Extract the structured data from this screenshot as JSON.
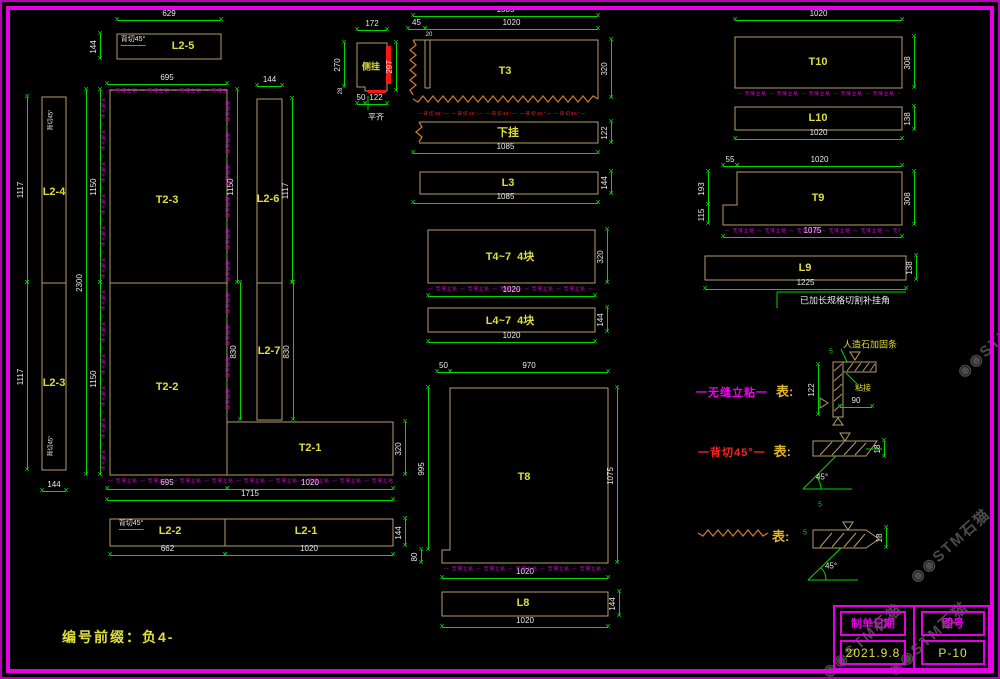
{
  "sheet": {
    "width": 1000,
    "height": 679,
    "watermark": "◉◉STM石猫"
  },
  "colors": {
    "magenta": "#e400e4",
    "green": "#00d800",
    "tan": "#b49b6e",
    "yellow": "#dede3c",
    "red": "#ff1414",
    "orange": "#c87830",
    "white": "#e8e8e8",
    "watermark": "#545454"
  },
  "prefix_note": "编号前缀：负4-",
  "title_block": {
    "col1_header": "制单日期",
    "col2_header": "图号",
    "date": "2021.9.8",
    "sheet_no": "P-10"
  },
  "legend": {
    "row1": {
      "style_label": "一无缝立粘一",
      "means_label": "表:"
    },
    "row2": {
      "style_label": "一背切45°一",
      "means_label": "表:"
    },
    "row3": {
      "means_label": "表:"
    }
  },
  "micro_m": "— 无缝立粘 — 无缝立粘 — 无缝立粘 — 无缝立粘 — 无缝立粘 — 无缝立粘 — 无缝立粘 — 无缝立粘 — 无缝立粘 — 无缝立粘 — 无缝立粘 — 无缝立粘 —",
  "micro_r": "—背切45°— —背切45°— —背切45°— —背切45°— —背切45°—",
  "labels": [
    [
      "T2-3",
      167,
      200
    ],
    [
      "T2-2",
      167,
      387
    ],
    [
      "T2-1",
      310,
      448
    ],
    [
      "L2-4",
      54,
      192
    ],
    [
      "L2-3",
      54,
      383
    ],
    [
      "L2-5",
      183,
      46
    ],
    [
      "L2-6",
      268,
      199
    ],
    [
      "L2-7",
      269,
      351
    ],
    [
      "L2-2",
      170,
      531
    ],
    [
      "L2-1",
      306,
      531
    ],
    [
      "T3",
      505,
      71
    ],
    [
      "下挂",
      508,
      132
    ],
    [
      "L3",
      508,
      183
    ],
    [
      "T4~7  4块",
      510,
      256
    ],
    [
      "L4~7  4块",
      510,
      320
    ],
    [
      "T8",
      524,
      477
    ],
    [
      "L8",
      523,
      603
    ],
    [
      "T10",
      818,
      62
    ],
    [
      "L10",
      818,
      118
    ],
    [
      "T9",
      818,
      198
    ],
    [
      "L9",
      805,
      268
    ],
    [
      "侧挂",
      371,
      66,
      9
    ]
  ],
  "dims_h": [
    [
      "629",
      117,
      221,
      20
    ],
    [
      "695",
      107,
      227,
      84
    ],
    [
      "144",
      257,
      282,
      86
    ],
    [
      "172",
      357,
      387,
      30
    ],
    [
      "1085",
      413,
      598,
      16
    ],
    [
      "1020",
      425,
      598,
      29
    ],
    [
      "45",
      408,
      425,
      29
    ],
    [
      "50",
      357,
      365,
      104
    ],
    [
      "122",
      365,
      387,
      104
    ],
    [
      "1085",
      413,
      598,
      153
    ],
    [
      "1085",
      413,
      598,
      203
    ],
    [
      "1020",
      428,
      595,
      296
    ],
    [
      "1020",
      428,
      595,
      342
    ],
    [
      "50",
      437,
      450,
      372
    ],
    [
      "970",
      450,
      608,
      372
    ],
    [
      "1020",
      442,
      608,
      578
    ],
    [
      "1020",
      442,
      608,
      627
    ],
    [
      "1020",
      735,
      902,
      20
    ],
    [
      "1020",
      735,
      902,
      139
    ],
    [
      "55",
      723,
      737,
      166
    ],
    [
      "1020",
      737,
      902,
      166
    ],
    [
      "1075",
      723,
      902,
      237
    ],
    [
      "1225",
      705,
      906,
      289
    ],
    [
      "695",
      107,
      227,
      489
    ],
    [
      "1020",
      227,
      393,
      489
    ],
    [
      "1715",
      107,
      393,
      500
    ],
    [
      "662",
      110,
      225,
      555
    ],
    [
      "1020",
      225,
      393,
      555
    ],
    [
      "144",
      42,
      66,
      491
    ],
    [
      "90",
      840,
      872,
      407
    ]
  ],
  "dims_v": [
    [
      "144",
      34,
      59,
      100
    ],
    [
      "1117",
      97,
      283,
      27
    ],
    [
      "1117",
      283,
      470,
      27
    ],
    [
      "2300",
      90,
      475,
      86
    ],
    [
      "1150",
      90,
      283,
      100
    ],
    [
      "1150",
      283,
      475,
      100
    ],
    [
      "1150",
      90,
      283,
      237
    ],
    [
      "1117",
      99,
      283,
      292
    ],
    [
      "830",
      283,
      420,
      240
    ],
    [
      "830",
      283,
      420,
      293
    ],
    [
      "320",
      422,
      475,
      405
    ],
    [
      "144",
      519,
      546,
      405
    ],
    [
      "270",
      43,
      87,
      344
    ],
    [
      "297",
      43,
      91,
      396
    ],
    [
      "320",
      40,
      98,
      611
    ],
    [
      "122",
      122,
      143,
      611
    ],
    [
      "144",
      172,
      194,
      611
    ],
    [
      "320",
      230,
      283,
      607
    ],
    [
      "144",
      308,
      332,
      607
    ],
    [
      "995",
      388,
      550,
      428
    ],
    [
      "80",
      550,
      563,
      421
    ],
    [
      "1075",
      388,
      563,
      617
    ],
    [
      "144",
      592,
      616,
      619
    ],
    [
      "308",
      37,
      88,
      914
    ],
    [
      "138",
      107,
      130,
      914
    ],
    [
      "193",
      172,
      205,
      708
    ],
    [
      "115",
      205,
      224,
      708
    ],
    [
      "308",
      172,
      225,
      914
    ],
    [
      "138",
      256,
      280,
      916
    ],
    [
      "122",
      365,
      415,
      818
    ],
    [
      "18",
      441,
      457,
      884
    ],
    [
      "18",
      528,
      548,
      886
    ]
  ],
  "notes": [
    {
      "t": "背切45°",
      "x": 133,
      "y": 40,
      "s": 7,
      "u": 1
    },
    {
      "t": "背切45°",
      "x": 50,
      "y": 120,
      "s": 6,
      "rot": -90
    },
    {
      "t": "背切45°",
      "x": 50,
      "y": 446,
      "s": 6,
      "rot": -90
    },
    {
      "t": "背切45°",
      "x": 131,
      "y": 524,
      "s": 7,
      "u": 1
    },
    {
      "t": "平齐",
      "x": 376,
      "y": 117,
      "s": 8
    },
    {
      "t": "已加长规格切割补挂角",
      "x": 845,
      "y": 300,
      "s": 9
    },
    {
      "t": "人造石加固条",
      "x": 870,
      "y": 344,
      "s": 9,
      "c": "#dede3c"
    },
    {
      "t": "粘接",
      "x": 863,
      "y": 388,
      "s": 8,
      "c": "#dede3c"
    },
    {
      "t": "45°",
      "x": 822,
      "y": 477,
      "s": 8
    },
    {
      "t": "45°",
      "x": 831,
      "y": 566,
      "s": 8
    },
    {
      "t": "20",
      "x": 429,
      "y": 35,
      "s": 6
    },
    {
      "t": "28",
      "x": 341,
      "y": 91,
      "s": 6,
      "rot": -90
    },
    {
      "t": "5",
      "x": 831,
      "y": 352,
      "s": 7,
      "c": "#00d800"
    },
    {
      "t": "5",
      "x": 820,
      "y": 505,
      "s": 7,
      "c": "#00d800"
    },
    {
      "t": "5",
      "x": 805,
      "y": 533,
      "s": 7,
      "c": "#00d800"
    }
  ],
  "dashes": [
    {
      "x": 108,
      "y": 88,
      "len": 119,
      "v": 0,
      "c": "m"
    },
    {
      "x": 105,
      "y": 90,
      "len": 388,
      "v": 1,
      "c": "m"
    },
    {
      "x": 230,
      "y": 93,
      "len": 327,
      "v": 1,
      "c": "m"
    },
    {
      "x": 108,
      "y": 478,
      "len": 285,
      "v": 0,
      "c": "m"
    },
    {
      "x": 428,
      "y": 286,
      "len": 167,
      "v": 0,
      "c": "m"
    },
    {
      "x": 444,
      "y": 566,
      "len": 162,
      "v": 0,
      "c": "m"
    },
    {
      "x": 737,
      "y": 91,
      "len": 163,
      "v": 0,
      "c": "m"
    },
    {
      "x": 725,
      "y": 228,
      "len": 175,
      "v": 0,
      "c": "m"
    },
    {
      "x": 418,
      "y": 111,
      "len": 182,
      "v": 0,
      "c": "r"
    }
  ],
  "watermarks": [
    {
      "x": 950,
      "y": 545
    },
    {
      "x": 928,
      "y": 638
    },
    {
      "x": 862,
      "y": 640
    },
    {
      "x": 997,
      "y": 340
    }
  ],
  "svg_shapes": [
    {
      "k": "r",
      "x": 117,
      "y": 34,
      "w": 104,
      "h": 25,
      "n": "panel-L2-5"
    },
    {
      "k": "r",
      "x": 42,
      "y": 97,
      "w": 24,
      "h": 373,
      "n": "panel-L2-4-L2-3"
    },
    {
      "k": "l",
      "x1": 42,
      "y1": 283,
      "x2": 66,
      "y2": 283
    },
    {
      "k": "p",
      "pts": "110,90 227,90 227,422 393,422 393,475 110,475",
      "n": "panel-T2-main"
    },
    {
      "k": "l",
      "x1": 110,
      "y1": 283,
      "x2": 227,
      "y2": 283
    },
    {
      "k": "l",
      "x1": 227,
      "y1": 422,
      "x2": 227,
      "y2": 475
    },
    {
      "k": "r",
      "x": 257,
      "y": 99,
      "w": 25,
      "h": 184,
      "n": "panel-L2-6"
    },
    {
      "k": "r",
      "x": 257,
      "y": 283,
      "w": 25,
      "h": 137,
      "n": "panel-L2-7"
    },
    {
      "k": "r",
      "x": 110,
      "y": 519,
      "w": 283,
      "h": 27,
      "n": "panel-L2-2-L2-1"
    },
    {
      "k": "l",
      "x1": 225,
      "y1": 519,
      "x2": 225,
      "y2": 546
    },
    {
      "k": "p",
      "pts": "357,43 387,43 387,91 365,91 365,87 357,87",
      "n": "panel-cegua-detail"
    },
    {
      "k": "pl",
      "pts": "413,40 598,40 598,99",
      "n": "panel-T3"
    },
    {
      "k": "l",
      "x1": 425,
      "y1": 40,
      "x2": 425,
      "y2": 88
    },
    {
      "k": "l",
      "x1": 430,
      "y1": 40,
      "x2": 430,
      "y2": 88
    },
    {
      "k": "l",
      "x1": 425,
      "y1": 88,
      "x2": 430,
      "y2": 88
    },
    {
      "k": "pl",
      "pts": "419,122 598,122 598,143 419,143",
      "n": "panel-xiagua"
    },
    {
      "k": "r",
      "x": 420,
      "y": 172,
      "w": 178,
      "h": 22,
      "n": "panel-L3"
    },
    {
      "k": "r",
      "x": 428,
      "y": 230,
      "w": 167,
      "h": 53,
      "n": "panel-T4-7"
    },
    {
      "k": "r",
      "x": 428,
      "y": 308,
      "w": 167,
      "h": 24,
      "n": "panel-L4-7"
    },
    {
      "k": "p",
      "pts": "450,388 608,388 608,563 442,563 442,550 450,550",
      "n": "panel-T8"
    },
    {
      "k": "r",
      "x": 442,
      "y": 592,
      "w": 166,
      "h": 24,
      "n": "panel-L8"
    },
    {
      "k": "r",
      "x": 735,
      "y": 37,
      "w": 167,
      "h": 51,
      "n": "panel-T10"
    },
    {
      "k": "r",
      "x": 735,
      "y": 107,
      "w": 167,
      "h": 23,
      "n": "panel-L10"
    },
    {
      "k": "p",
      "pts": "737,172 902,172 902,225 723,225 723,205 737,205",
      "n": "panel-T9"
    },
    {
      "k": "r",
      "x": 705,
      "y": 256,
      "w": 201,
      "h": 24,
      "n": "panel-L9"
    },
    {
      "k": "z",
      "x1": 413,
      "y1": 40,
      "x2": 413,
      "y2": 99
    },
    {
      "k": "z",
      "x1": 413,
      "y1": 99,
      "x2": 598,
      "y2": 99
    },
    {
      "k": "z",
      "x1": 419,
      "y1": 122,
      "x2": 419,
      "y2": 143
    },
    {
      "k": "z",
      "x1": 698,
      "y1": 533,
      "x2": 770,
      "y2": 533
    },
    {
      "k": "f",
      "x": 386,
      "y": 46,
      "w": 5,
      "h": 38
    },
    {
      "k": "f",
      "x": 368,
      "y": 90,
      "w": 18,
      "h": 3
    },
    {
      "k": "l",
      "x1": 368,
      "y1": 96,
      "x2": 368,
      "y2": 110,
      "s": "g"
    },
    {
      "k": "l",
      "x1": 777,
      "y1": 292,
      "x2": 777,
      "y2": 308,
      "s": "g"
    },
    {
      "k": "l",
      "x1": 777,
      "y1": 292,
      "x2": 906,
      "y2": 292,
      "s": "g"
    },
    {
      "k": "r",
      "x": 833,
      "y": 362,
      "w": 10,
      "h": 55
    },
    {
      "k": "r",
      "x": 843,
      "y": 362,
      "w": 33,
      "h": 10
    },
    {
      "k": "l",
      "x1": 834,
      "y1": 371,
      "x2": 842,
      "y2": 364
    },
    {
      "k": "l",
      "x1": 834,
      "y1": 381,
      "x2": 842,
      "y2": 374
    },
    {
      "k": "l",
      "x1": 834,
      "y1": 391,
      "x2": 842,
      "y2": 384
    },
    {
      "k": "l",
      "x1": 834,
      "y1": 401,
      "x2": 842,
      "y2": 394
    },
    {
      "k": "l",
      "x1": 834,
      "y1": 411,
      "x2": 842,
      "y2": 404
    },
    {
      "k": "l",
      "x1": 847,
      "y1": 371,
      "x2": 853,
      "y2": 363
    },
    {
      "k": "l",
      "x1": 855,
      "y1": 371,
      "x2": 861,
      "y2": 363
    },
    {
      "k": "l",
      "x1": 863,
      "y1": 371,
      "x2": 869,
      "y2": 363
    },
    {
      "k": "l",
      "x1": 870,
      "y1": 371,
      "x2": 875,
      "y2": 364
    },
    {
      "k": "p",
      "pts": "850,352 860,352 855,360"
    },
    {
      "k": "p",
      "pts": "833,425 843,425 838,418"
    },
    {
      "k": "p",
      "pts": "820,398 820,408 828,403"
    },
    {
      "k": "l",
      "x1": 847,
      "y1": 362,
      "x2": 841,
      "y2": 349,
      "s": "g"
    },
    {
      "k": "l",
      "x1": 846,
      "y1": 373,
      "x2": 857,
      "y2": 384,
      "s": "g"
    },
    {
      "k": "p",
      "pts": "813,441 877,441 866,456 813,456"
    },
    {
      "k": "l",
      "x1": 820,
      "y1": 455,
      "x2": 832,
      "y2": 442
    },
    {
      "k": "l",
      "x1": 832,
      "y1": 455,
      "x2": 844,
      "y2": 442
    },
    {
      "k": "l",
      "x1": 844,
      "y1": 455,
      "x2": 856,
      "y2": 442
    },
    {
      "k": "l",
      "x1": 855,
      "y1": 455,
      "x2": 866,
      "y2": 443
    },
    {
      "k": "p",
      "pts": "840,433 850,433 845,441"
    },
    {
      "k": "l",
      "x1": 866,
      "y1": 449,
      "x2": 882,
      "y2": 449,
      "s": "g"
    },
    {
      "k": "l",
      "x1": 803,
      "y1": 489,
      "x2": 852,
      "y2": 489,
      "s": "g"
    },
    {
      "k": "l",
      "x1": 803,
      "y1": 489,
      "x2": 836,
      "y2": 456,
      "s": "g"
    },
    {
      "k": "a",
      "d": "M821,489 A18,18 0 0 0 815.7,476.3",
      "s": "g"
    },
    {
      "k": "p",
      "pts": "813,530 866,530 879,539 866,548 813,548"
    },
    {
      "k": "l",
      "x1": 820,
      "y1": 547,
      "x2": 832,
      "y2": 533
    },
    {
      "k": "l",
      "x1": 832,
      "y1": 547,
      "x2": 844,
      "y2": 533
    },
    {
      "k": "l",
      "x1": 844,
      "y1": 547,
      "x2": 856,
      "y2": 533
    },
    {
      "k": "l",
      "x1": 854,
      "y1": 547,
      "x2": 865,
      "y2": 534
    },
    {
      "k": "p",
      "pts": "843,522 853,522 848,530"
    },
    {
      "k": "l",
      "x1": 808,
      "y1": 580,
      "x2": 858,
      "y2": 580,
      "s": "g"
    },
    {
      "k": "l",
      "x1": 808,
      "y1": 580,
      "x2": 841,
      "y2": 548,
      "s": "g"
    },
    {
      "k": "a",
      "d": "M826,580 A18,18 0 0 0 820.7,567.3",
      "s": "g"
    }
  ]
}
